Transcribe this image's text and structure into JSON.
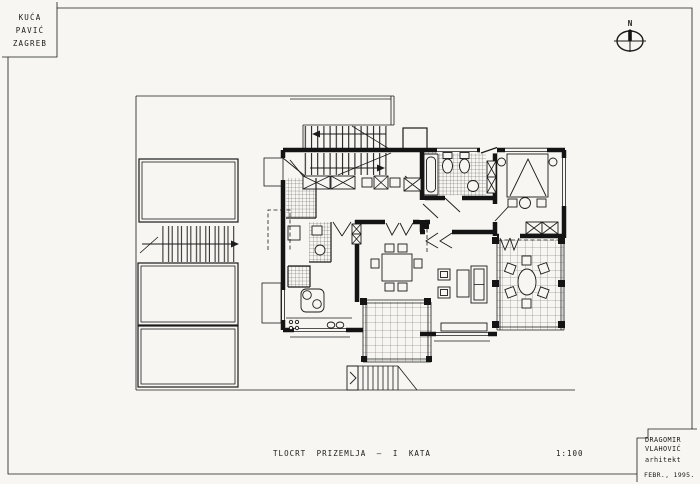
{
  "sheet": {
    "paper_color": "#f7f6f2",
    "ink_color": "#1b1b1b",
    "project_box": {
      "lines": [
        "KUĆA",
        "PAVIĆ",
        "ZAGREB"
      ]
    },
    "compass": {
      "label": "N"
    },
    "caption": {
      "title": "TLOCRT PRIZEMLJA — I KATA",
      "scale": "1:100"
    },
    "architect_box": {
      "lines": [
        "DRAGOMIR",
        "VLAHOVIĆ",
        "arhitekt"
      ],
      "date": "FEBR., 1995."
    }
  }
}
